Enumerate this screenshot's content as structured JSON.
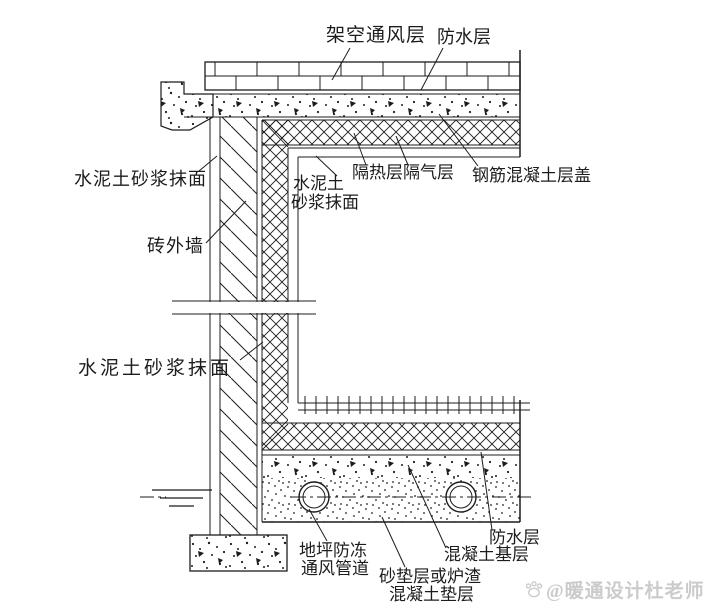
{
  "drawing": {
    "kind": "construction-detail-section",
    "annotations": {
      "roof_vent_layer": "架空通风层",
      "waterproof_top": "防水层",
      "insulation_vapor": "隔热层隔气层",
      "rc_roof_slab": "钢筋混凝土层盖",
      "interior_plaster_line1": "水泥土",
      "interior_plaster_line2": "砂浆抹面",
      "exterior_plaster_upper": "水泥土砂浆抹面",
      "brick_wall": "砖外墙",
      "exterior_plaster_lower": "水泥土砂浆抹面",
      "frost_pipe_line1": "地坪防冻",
      "frost_pipe_line2": "通风管道",
      "cushion_line1": "砂垫层或炉渣",
      "cushion_line2": "混凝土垫层",
      "concrete_base": "混凝土基层",
      "waterproof_bottom": "防水层"
    }
  },
  "watermark": {
    "text": "@暖通设计杜老师",
    "icon": "paw-icon",
    "color": "#cbcbcb"
  },
  "colors": {
    "ink": "#1c1c1c",
    "background": "#ffffff"
  }
}
